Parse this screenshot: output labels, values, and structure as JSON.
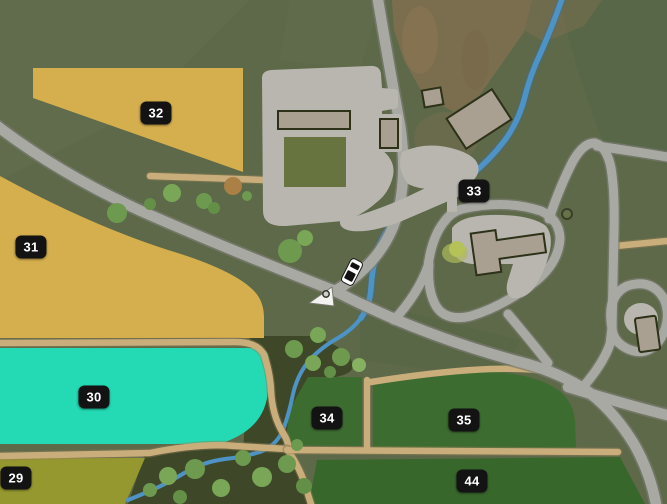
{
  "map": {
    "name": "in-game farm map view",
    "field_labels": [
      {
        "number": "32"
      },
      {
        "number": "31"
      },
      {
        "number": "30"
      },
      {
        "number": "29"
      },
      {
        "number": "33"
      },
      {
        "number": "34"
      },
      {
        "number": "35"
      },
      {
        "number": "44"
      }
    ],
    "markers": {
      "vehicle": "truck-icon",
      "player": "player-arrow-icon"
    },
    "colors": {
      "grass": "#5d6949",
      "field_gold": "#d5ae4e",
      "field_teal": "#23dab4",
      "field_olive": "#95982f",
      "field_green": "#3d6c31",
      "field_green_dark": "#38672c",
      "woodland": "#3e4829",
      "road": "#a8a9a3",
      "dirt_road": "#c9ad7b",
      "river": "#4e93c5",
      "paved": "#b8b6af",
      "label_bg": "#131313",
      "label_text": "#ffffff"
    }
  }
}
